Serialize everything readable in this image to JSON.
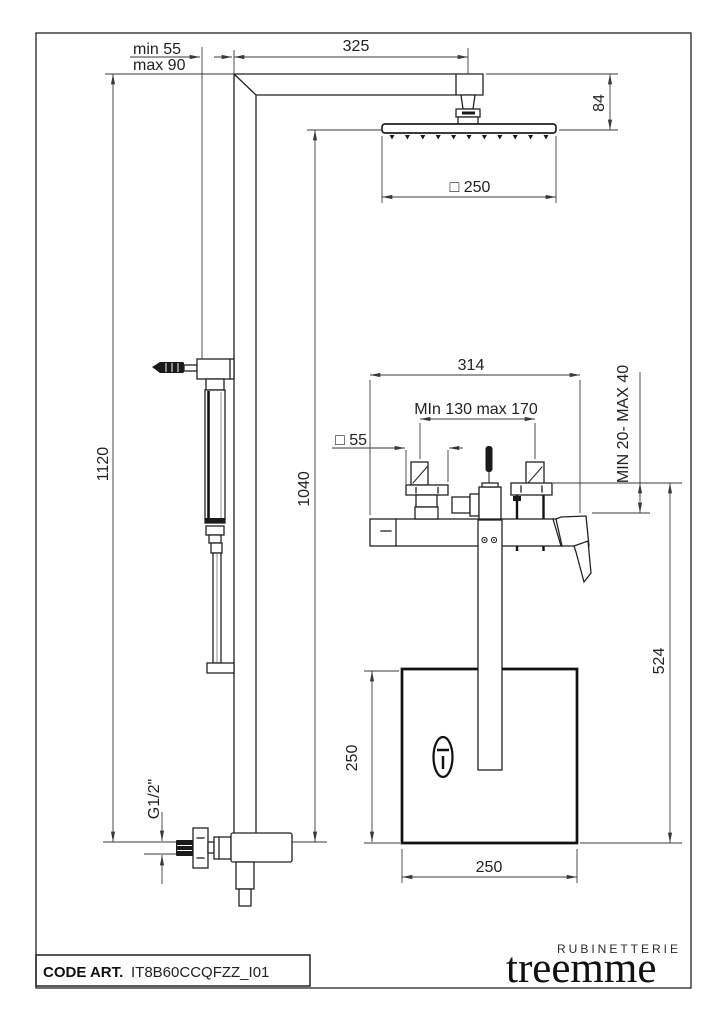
{
  "drawing": {
    "dimensions": {
      "bracket_min": "min 55",
      "bracket_max": "max 90",
      "arm_length": "325",
      "head_offset": "84",
      "head_size": "□ 250",
      "column_height": "1120",
      "head_height": "1040",
      "body_width": "314",
      "handle_spacing": "MIn 130 max 170",
      "escutcheon_size": "□ 55",
      "mounting_depth": "MIN 20- MAX 40",
      "spout_drop": "524",
      "plate_height": "250",
      "plate_width": "250",
      "inlet_thread": "G1/2\""
    }
  },
  "title_block": {
    "code_label": "CODE ART.",
    "code_value": "IT8B60CCQFZZ_I01"
  },
  "brand": {
    "sub": "RUBINETTERIE",
    "name": "treemme"
  }
}
